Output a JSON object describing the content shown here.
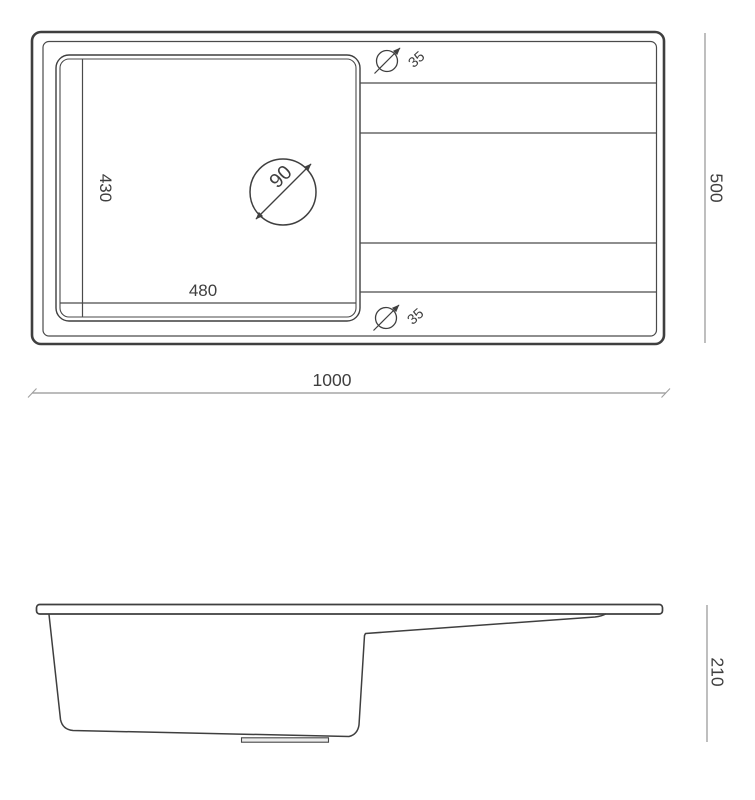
{
  "colors": {
    "line": "#3f3f3f",
    "line_light": "#4a4a4a",
    "dimension_line": "#949494",
    "background": "#ffffff"
  },
  "top_view": {
    "overall_width": "1000",
    "overall_depth": "500",
    "bowl_width": "480",
    "bowl_depth": "430",
    "drain_diameter": "90",
    "top_hole_diameter": "35",
    "bottom_hole_diameter": "35"
  },
  "side_view": {
    "height": "210"
  }
}
